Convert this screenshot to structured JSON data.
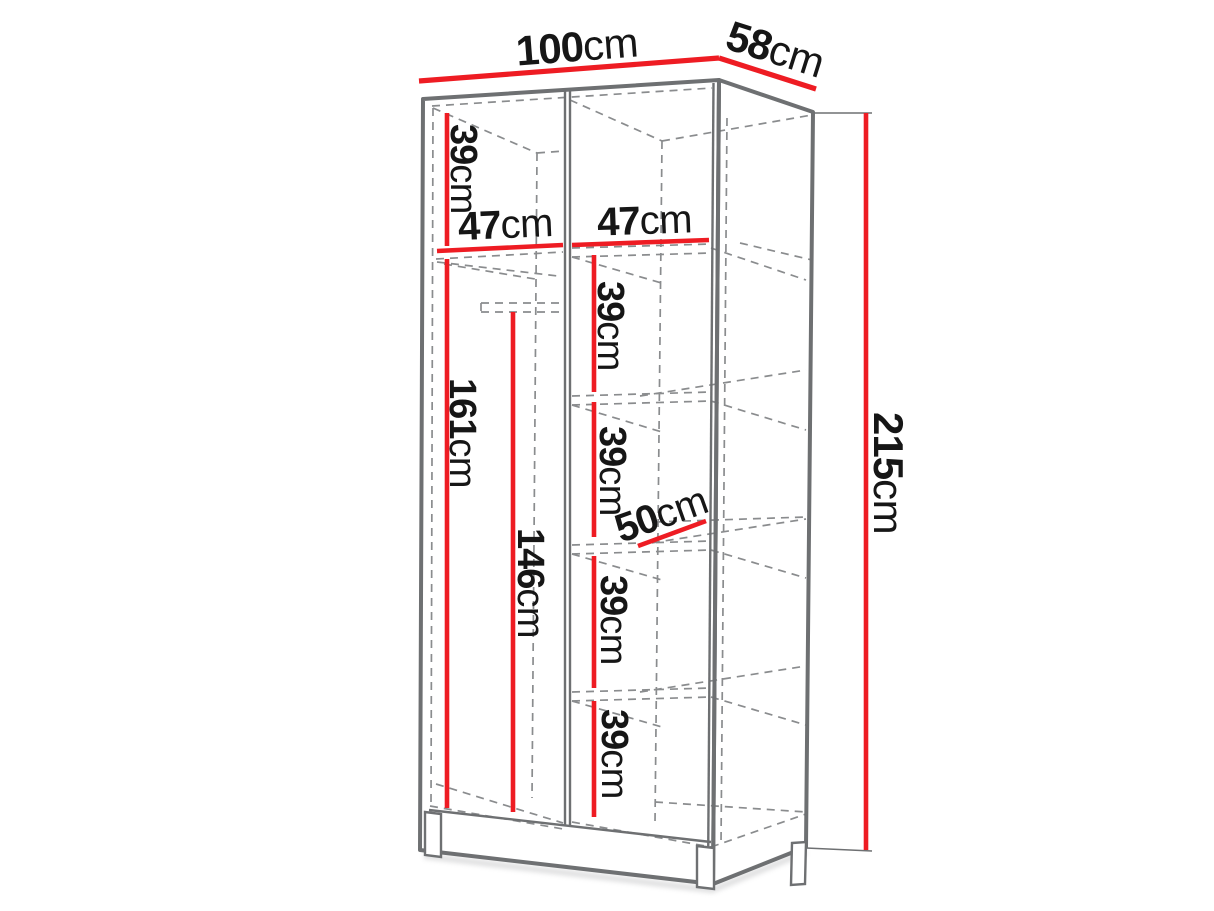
{
  "page": {
    "background": "#ffffff"
  },
  "diagram": {
    "kind": "wardrobe-interior-dimension-diagram",
    "unit": "cm",
    "colors": {
      "dimension": "#ee1c23",
      "outline": "#6e7072",
      "hidden": "#8a8c8e",
      "label": "#161616",
      "face": "#ffffff",
      "shadow": "#b9babc"
    },
    "overall": {
      "width": {
        "num": "100",
        "unit": "cm"
      },
      "depth": {
        "num": "58",
        "unit": "cm"
      },
      "height": {
        "num": "215",
        "unit": "cm"
      }
    },
    "interior": {
      "top_section_height": {
        "num": "39",
        "unit": "cm"
      },
      "left_section_width": {
        "num": "47",
        "unit": "cm"
      },
      "right_section_width": {
        "num": "47",
        "unit": "cm"
      },
      "hanging_section_height": {
        "num": "161",
        "unit": "cm"
      },
      "rail_clearance_height": {
        "num": "146",
        "unit": "cm"
      },
      "shelf_gap_1": {
        "num": "39",
        "unit": "cm"
      },
      "shelf_gap_2": {
        "num": "39",
        "unit": "cm"
      },
      "shelf_depth": {
        "num": "50",
        "unit": "cm"
      },
      "shelf_gap_3": {
        "num": "39",
        "unit": "cm"
      },
      "shelf_gap_4": {
        "num": "39",
        "unit": "cm"
      }
    }
  }
}
